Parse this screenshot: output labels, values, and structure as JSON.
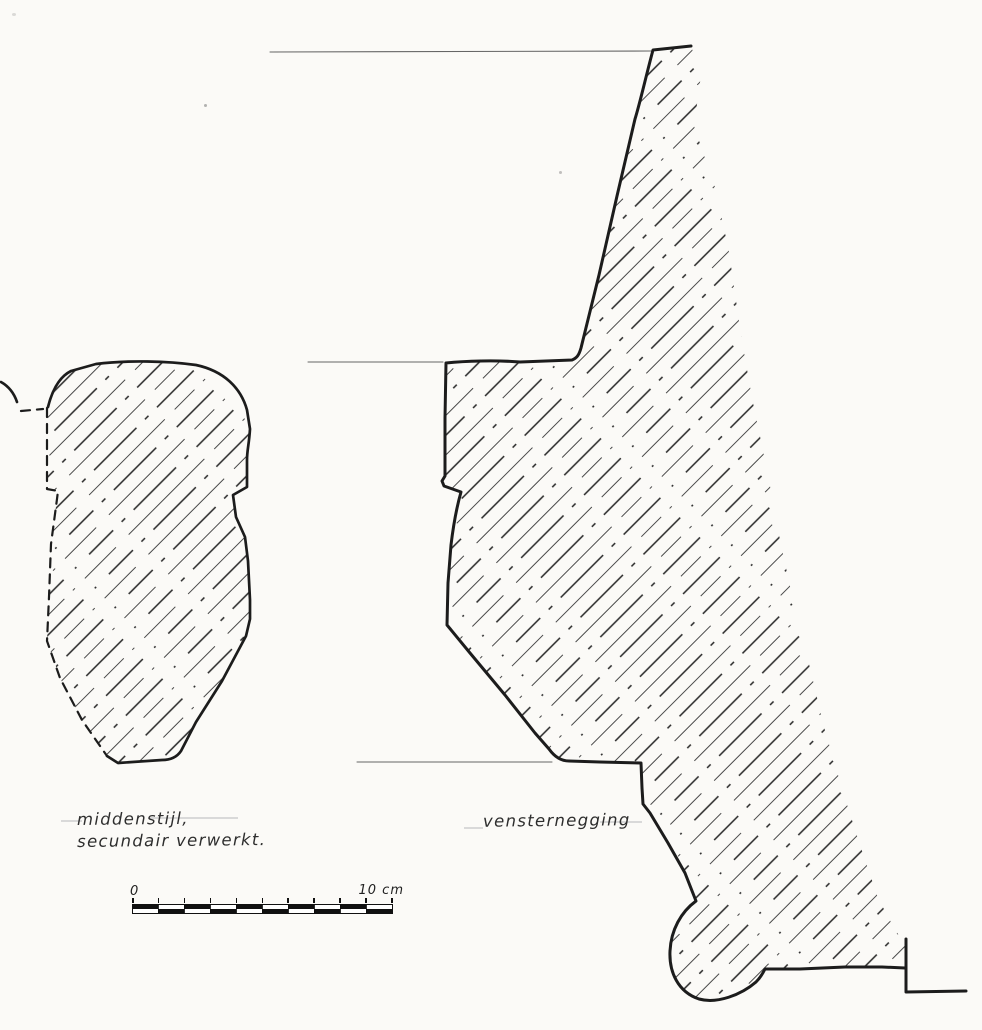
{
  "labels": {
    "left_line1": "middenstijl,",
    "left_line2": "secundair verwerkt.",
    "right": "vensternegging"
  },
  "scale_bar": {
    "start_label": "0",
    "end_label": "10 cm",
    "divisions": 10
  },
  "colors": {
    "ink": "#1c1c1c",
    "hatch_dark": "#262626",
    "hatch_light": "#4a4a4a",
    "faint_line": "#666666",
    "guide_line": "#d9d9d9",
    "paper": "#fbfaf7"
  }
}
